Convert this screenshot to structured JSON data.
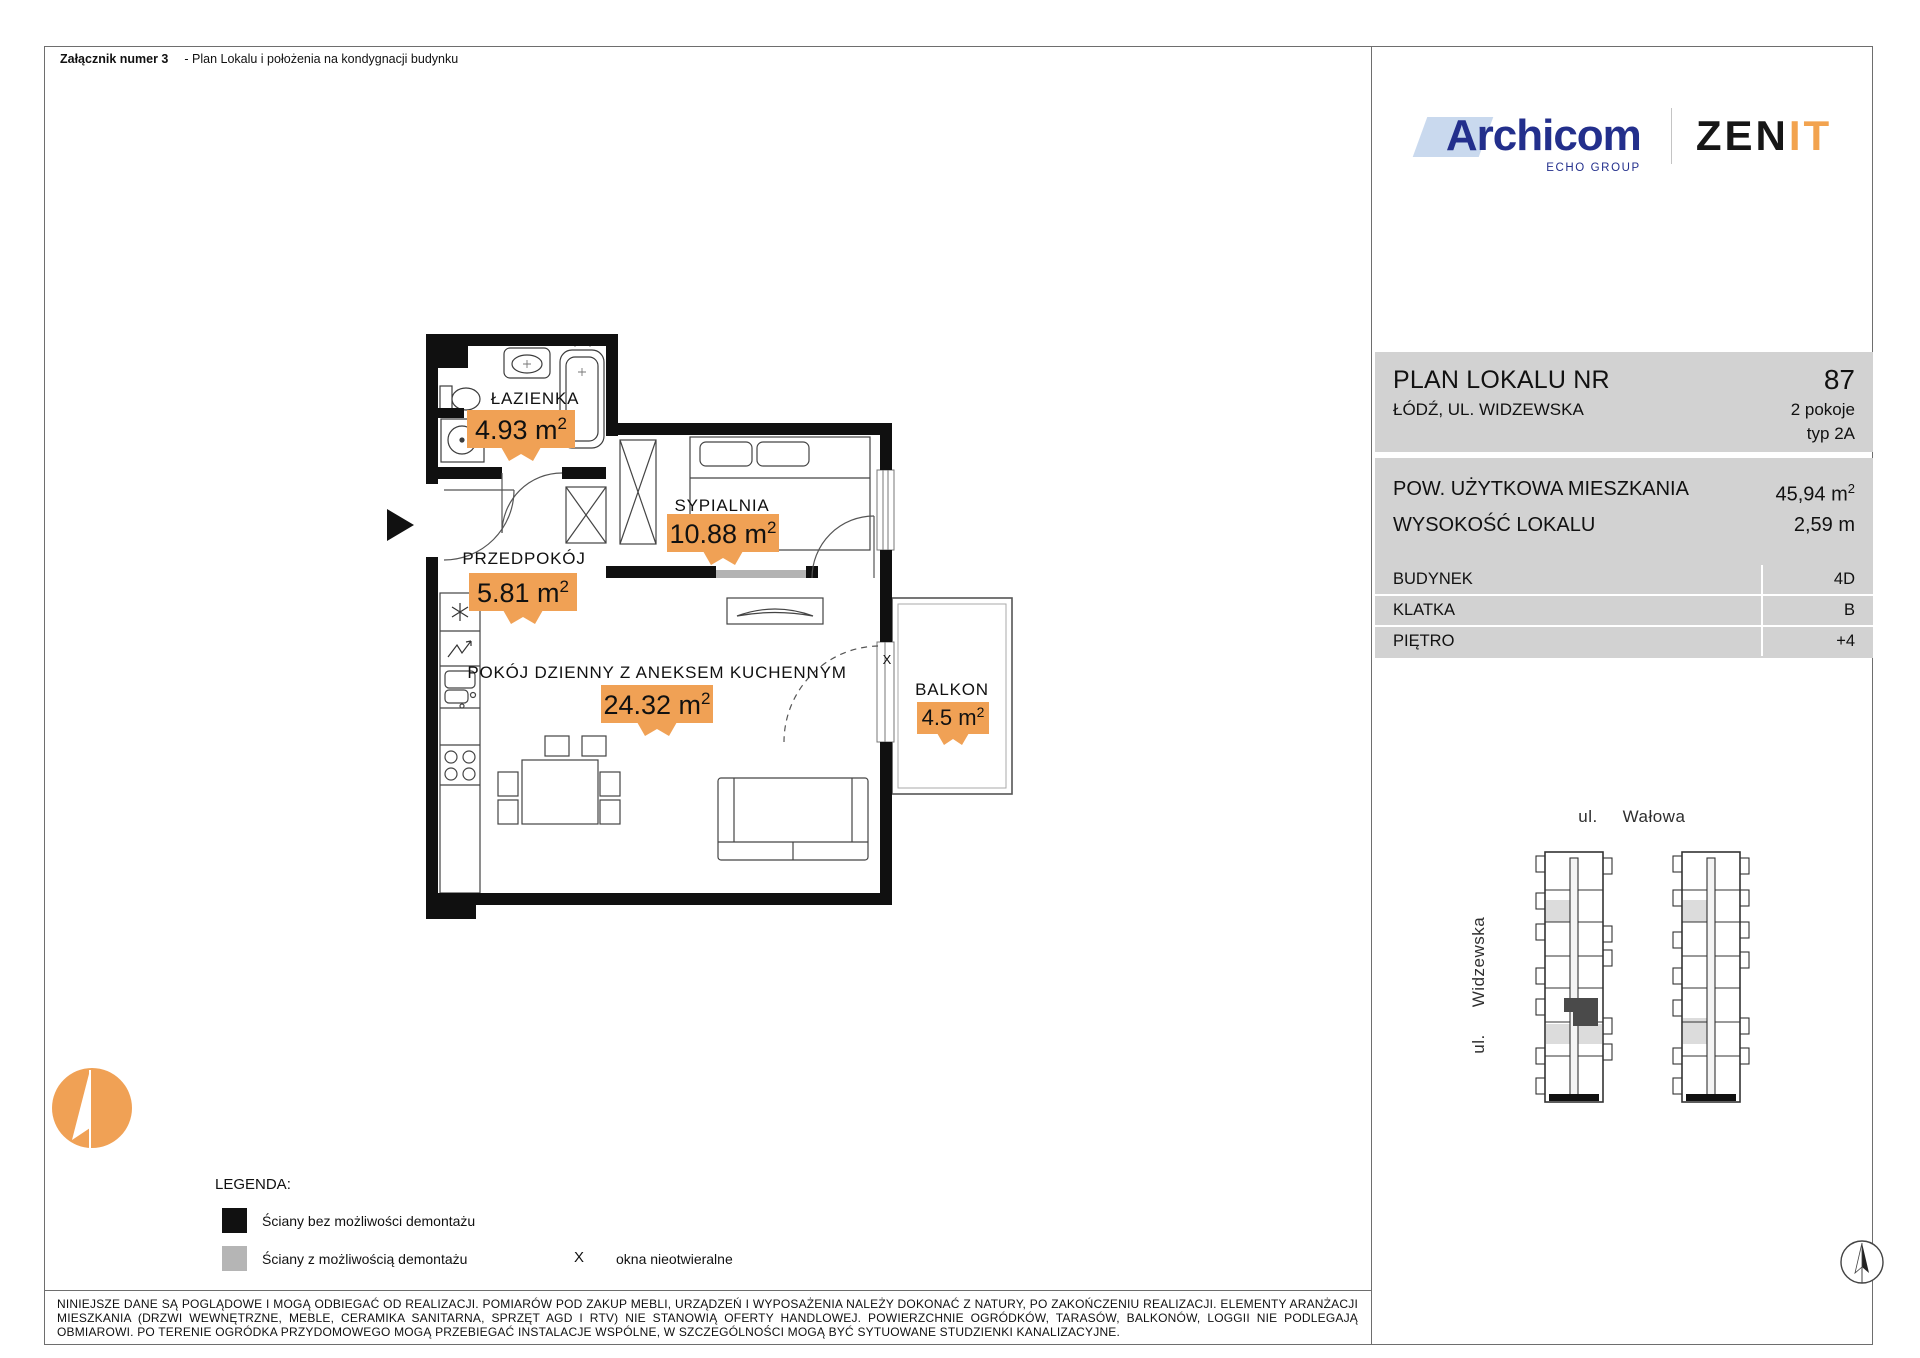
{
  "colors": {
    "orange": "#F0A155",
    "panel_gray": "#D2D2D2",
    "wall_black": "#101010",
    "wall_gray": "#B3B3B3",
    "navy": "#232F8C",
    "light_blue": "#C9D9EE",
    "zenit_orange": "#F2A34F",
    "highlight_unit": "#4A4A4A"
  },
  "title_bar": {
    "attachment": "Załącznik numer 3",
    "description": "- Plan Lokalu i położenia na kondygnacji budynku"
  },
  "brand": {
    "archicom": "Archicom",
    "echo_group": "ECHO GROUP",
    "zenit_zen": "ZEN",
    "zenit_it": "IT"
  },
  "plan_header": {
    "title": "PLAN LOKALU NR",
    "number": "87",
    "address": "ŁÓDŹ, UL. WIDZEWSKA",
    "rooms": "2 pokoje",
    "unit_type": "typ 2A"
  },
  "details": {
    "area_label": "POW. UŻYTKOWA MIESZKANIA",
    "area_value": "45,94 m",
    "area_sup": "2",
    "height_label": "WYSOKOŚĆ LOKALU",
    "height_value": "2,59 m",
    "rows": [
      {
        "label": "BUDYNEK",
        "value": "4D"
      },
      {
        "label": "KLATKA",
        "value": "B"
      },
      {
        "label": "PIĘTRO",
        "value": "+4"
      }
    ]
  },
  "floorplan": {
    "rooms": [
      {
        "name": "ŁAZIENKA",
        "area": "4.93 m",
        "sup": "2"
      },
      {
        "name": "SYPIALNIA",
        "area": "10.88 m",
        "sup": "2"
      },
      {
        "name": "PRZEDPOKÓJ",
        "area": "5.81 m",
        "sup": "2"
      },
      {
        "name": "POKÓJ DZIENNY Z ANEKSEM KUCHENNYM",
        "area": "24.32 m",
        "sup": "2"
      },
      {
        "name": "BALKON",
        "area": "4.5 m",
        "sup": "2"
      }
    ],
    "fixed_window_marker": "X"
  },
  "site_map": {
    "street_top_prefix": "ul.",
    "street_top_name": "Wałowa",
    "street_left_prefix": "ul.",
    "street_left_name": "Widzewska"
  },
  "legend": {
    "title": "LEGENDA:",
    "items": [
      {
        "label": "Ściany bez możliwości demontażu"
      },
      {
        "label": "Ściany z możliwością demontażu"
      }
    ],
    "window_marker": "X",
    "window_marker_label": "okna nieotwieralne"
  },
  "disclaimer": "NINIEJSZE DANE SĄ POGLĄDOWE I MOGĄ ODBIEGAĆ OD REALIZACJI. POMIARÓW POD ZAKUP MEBLI, URZĄDZEŃ I WYPOSAŻENIA NALEŻY DOKONAĆ Z NATURY, PO ZAKOŃCZENIU REALIZACJI. ELEMENTY ARANŻACJI MIESZKANIA (DRZWI WEWNĘTRZNE, MEBLE, CERAMIKA SANITARNA, SPRZĘT AGD I RTV) NIE STANOWIĄ OFERTY HANDLOWEJ. POWIERZCHNIE OGRÓDKÓW, TARASÓW, BALKONÓW, LOGGII NIE PODLEGAJĄ OBMIAROWI. PO TERENIE OGRÓDKA PRZYDOMOWEGO MOGĄ PRZEBIEGAĆ INSTALACJE WSPÓLNE, W SZCZEGÓLNOŚCI MOGĄ BYĆ SYTUOWANE STUDZIENKI KANALIZACYJNE."
}
